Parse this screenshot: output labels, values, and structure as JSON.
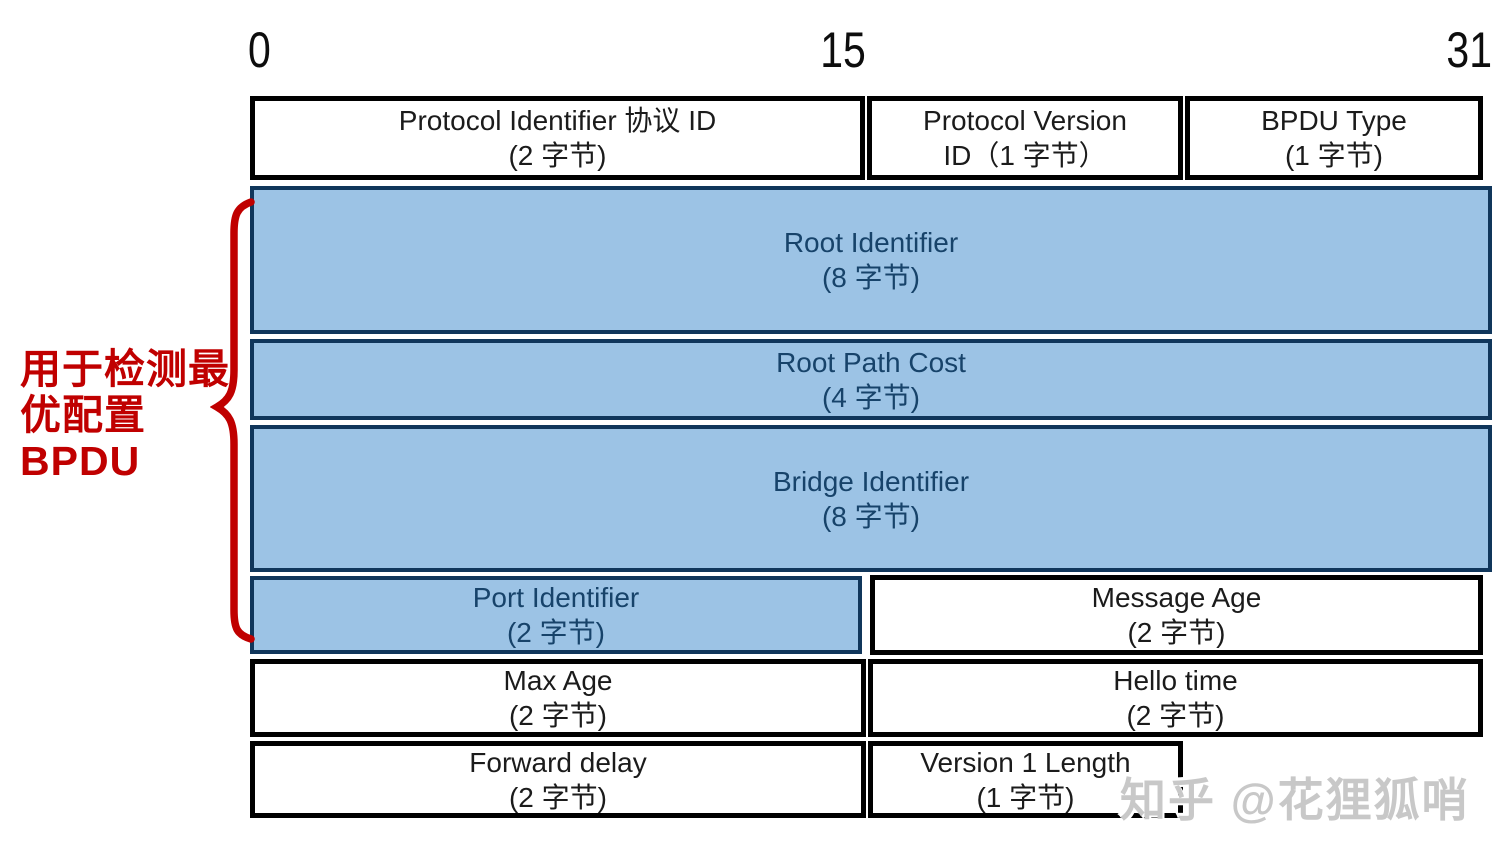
{
  "bit_scale": {
    "labels": [
      "0",
      "15",
      "31"
    ]
  },
  "fields": [
    {
      "id": "protocol-identifier",
      "line1": "Protocol Identifier 协议 ID",
      "line2": "(2 字节)",
      "style": "white"
    },
    {
      "id": "protocol-version",
      "line1": "Protocol Version",
      "line2": "ID（1 字节）",
      "style": "white"
    },
    {
      "id": "bpdu-type",
      "line1": "BPDU Type",
      "line2": "(1 字节)",
      "style": "white"
    },
    {
      "id": "root-identifier",
      "line1": "Root Identifier",
      "line2": "(8 字节)",
      "style": "blue"
    },
    {
      "id": "root-path-cost",
      "line1": "Root Path Cost",
      "line2": "(4 字节)",
      "style": "blue"
    },
    {
      "id": "bridge-identifier",
      "line1": "Bridge Identifier",
      "line2": "(8 字节)",
      "style": "blue"
    },
    {
      "id": "port-identifier",
      "line1": "Port Identifier",
      "line2": "(2 字节)",
      "style": "blue"
    },
    {
      "id": "message-age",
      "line1": "Message Age",
      "line2": "(2 字节)",
      "style": "white"
    },
    {
      "id": "max-age",
      "line1": "Max Age",
      "line2": "(2 字节)",
      "style": "white"
    },
    {
      "id": "hello-time",
      "line1": "Hello time",
      "line2": "(2 字节)",
      "style": "white"
    },
    {
      "id": "forward-delay",
      "line1": "Forward delay",
      "line2": "(2 字节)",
      "style": "white"
    },
    {
      "id": "version1-length",
      "line1": "Version 1 Length",
      "line2": "(1 字节)",
      "style": "white"
    }
  ],
  "annotation": {
    "lines": [
      "用于检测最",
      "优配置",
      "BPDU"
    ],
    "full_text": "用于检测最优配置 BPDU"
  },
  "watermark": {
    "text": "知乎 @花狸狐哨"
  },
  "colors": {
    "field_blue_fill": "#9CC3E5",
    "field_blue_border": "#10365B",
    "blue_text": "#17436A",
    "black_text": "#1b1b1b",
    "annotation_red": "#C00000",
    "watermark_gray": "#C8C8C8"
  }
}
